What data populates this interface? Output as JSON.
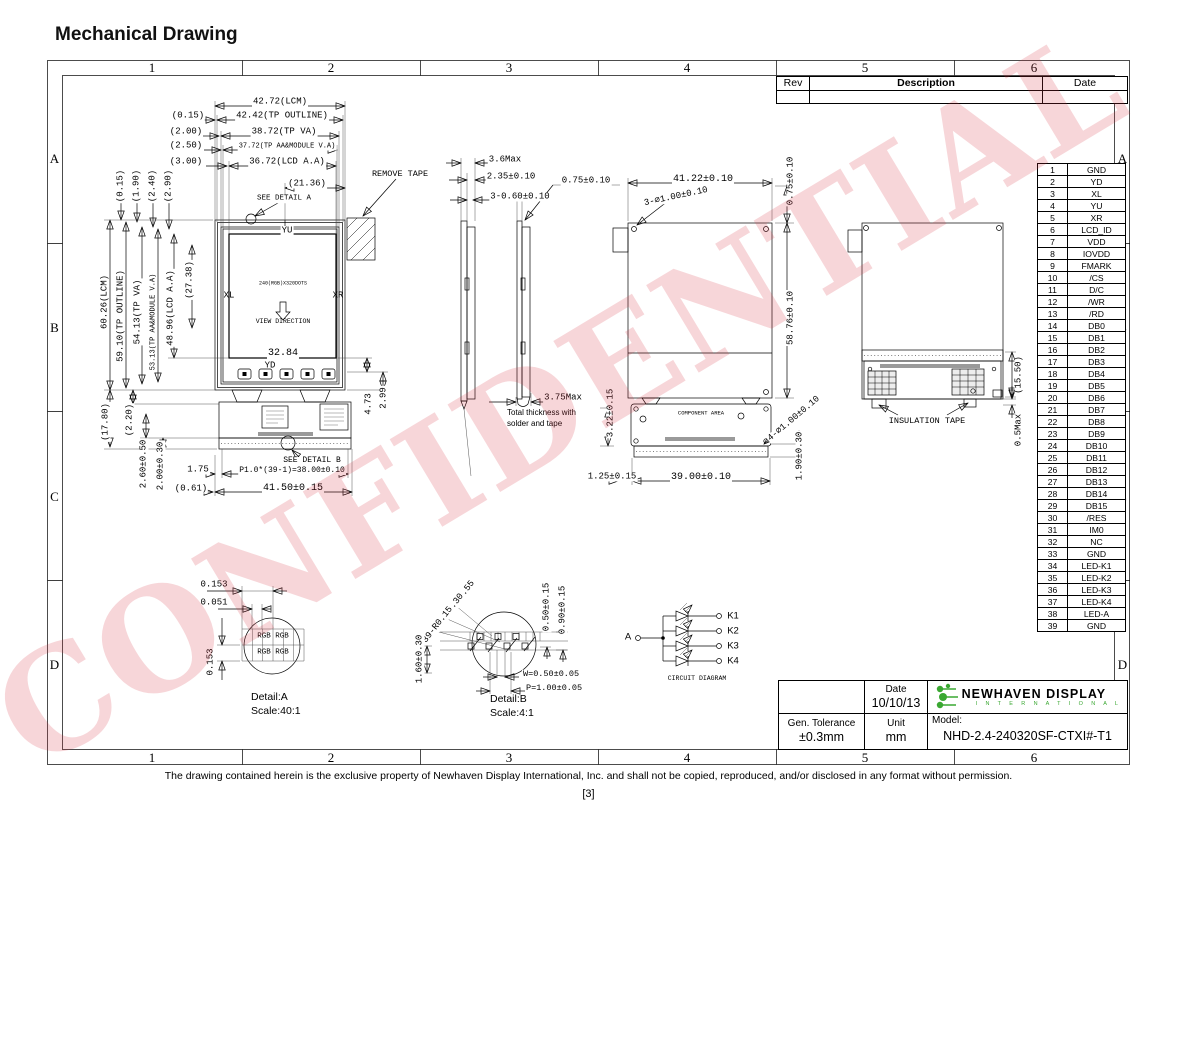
{
  "page": {
    "title": "Mechanical Drawing",
    "watermark": "CONFIDENTIAL",
    "footer": "The drawing contained herein is the exclusive property of Newhaven Display International, Inc. and shall not be copied, reproduced, and/or disclosed in any format without permission.",
    "page_number": "[3]"
  },
  "colors": {
    "watermark": "rgba(213,52,66,0.20)",
    "logo_green": "#3aa832",
    "line": "#000000"
  },
  "grid": {
    "cols": [
      "1",
      "2",
      "3",
      "4",
      "5",
      "6"
    ],
    "rows": [
      "A",
      "B",
      "C",
      "D"
    ]
  },
  "rev_table": {
    "col_rev": "Rev",
    "col_desc": "Description",
    "col_date": "Date",
    "empty_row": [
      "",
      "",
      ""
    ]
  },
  "title_block": {
    "date_label": "Date",
    "date": "10/10/13",
    "tolerance_label": "Gen. Tolerance",
    "tolerance": "±0.3mm",
    "unit_label": "Unit",
    "unit": "mm",
    "model_label": "Model:",
    "model": "NHD-2.4-240320SF-CTXI#-T1"
  },
  "logo": {
    "line1": "NEWHAVEN DISPLAY",
    "line2": "I N T E R N A T I O N A L"
  },
  "pin_table": {
    "pins": [
      {
        "no": "1",
        "name": "GND"
      },
      {
        "no": "2",
        "name": "YD"
      },
      {
        "no": "3",
        "name": "XL"
      },
      {
        "no": "4",
        "name": "YU"
      },
      {
        "no": "5",
        "name": "XR"
      },
      {
        "no": "6",
        "name": "LCD_ID"
      },
      {
        "no": "7",
        "name": "VDD"
      },
      {
        "no": "8",
        "name": "IOVDD"
      },
      {
        "no": "9",
        "name": "FMARK"
      },
      {
        "no": "10",
        "name": "/CS"
      },
      {
        "no": "11",
        "name": "D/C"
      },
      {
        "no": "12",
        "name": "/WR"
      },
      {
        "no": "13",
        "name": "/RD"
      },
      {
        "no": "14",
        "name": "DB0"
      },
      {
        "no": "15",
        "name": "DB1"
      },
      {
        "no": "16",
        "name": "DB2"
      },
      {
        "no": "17",
        "name": "DB3"
      },
      {
        "no": "18",
        "name": "DB4"
      },
      {
        "no": "19",
        "name": "DB5"
      },
      {
        "no": "20",
        "name": "DB6"
      },
      {
        "no": "21",
        "name": "DB7"
      },
      {
        "no": "22",
        "name": "DB8"
      },
      {
        "no": "23",
        "name": "DB9"
      },
      {
        "no": "24",
        "name": "DB10"
      },
      {
        "no": "25",
        "name": "DB11"
      },
      {
        "no": "26",
        "name": "DB12"
      },
      {
        "no": "27",
        "name": "DB13"
      },
      {
        "no": "28",
        "name": "DB14"
      },
      {
        "no": "29",
        "name": "DB15"
      },
      {
        "no": "30",
        "name": "/RES"
      },
      {
        "no": "31",
        "name": "IM0"
      },
      {
        "no": "32",
        "name": "NC"
      },
      {
        "no": "33",
        "name": "GND"
      },
      {
        "no": "34",
        "name": "LED-K1"
      },
      {
        "no": "35",
        "name": "LED-K2"
      },
      {
        "no": "36",
        "name": "LED-K3"
      },
      {
        "no": "37",
        "name": "LED-K4"
      },
      {
        "no": "38",
        "name": "LED-A"
      },
      {
        "no": "39",
        "name": "GND"
      }
    ]
  },
  "dim_labels": [
    {
      "t": "42.72(LCM)",
      "x": 280,
      "y": 102
    },
    {
      "t": "(0.15)",
      "x": 188,
      "y": 116
    },
    {
      "t": "42.42(TP OUTLINE)",
      "x": 282,
      "y": 116
    },
    {
      "t": "(2.00)",
      "x": 186,
      "y": 132
    },
    {
      "t": "38.72(TP VA)",
      "x": 284,
      "y": 132
    },
    {
      "t": "(2.50)",
      "x": 186,
      "y": 146
    },
    {
      "t": "37.72(TP AA&MODULE V.A)",
      "x": 287,
      "y": 147,
      "s": 7
    },
    {
      "t": "(3.00)",
      "x": 186,
      "y": 162
    },
    {
      "t": "36.72(LCD A.A)",
      "x": 287,
      "y": 162
    },
    {
      "t": "(21.36)",
      "x": 307,
      "y": 184
    },
    {
      "t": "SEE DETAIL A",
      "x": 284,
      "y": 199,
      "s": 7.5
    },
    {
      "t": "REMOVE TAPE",
      "x": 400,
      "y": 174,
      "s": 8.5
    },
    {
      "t": "YU",
      "x": 287,
      "y": 231
    },
    {
      "t": "XL",
      "x": 229,
      "y": 296,
      "nb": 1
    },
    {
      "t": "XR",
      "x": 338,
      "y": 296,
      "nb": 1
    },
    {
      "t": "240(RGB)X320DOTS",
      "x": 283,
      "y": 284,
      "s": 5,
      "nb": 1
    },
    {
      "t": "VIEW DIRECTION",
      "x": 283,
      "y": 322,
      "s": 6.5,
      "nb": 1
    },
    {
      "t": "32.84",
      "x": 283,
      "y": 354,
      "s": 10
    },
    {
      "t": "YD",
      "x": 270,
      "y": 366,
      "nb": 1
    },
    {
      "t": "4.73",
      "x": 369,
      "y": 404,
      "r": -90
    },
    {
      "t": "2.99",
      "x": 384,
      "y": 398,
      "r": -90
    },
    {
      "t": "SEE DETAIL B",
      "x": 312,
      "y": 461,
      "s": 8
    },
    {
      "t": "1.75",
      "x": 198,
      "y": 470
    },
    {
      "t": "P1.0*(39-1)=38.00±0.10",
      "x": 292,
      "y": 471,
      "s": 8
    },
    {
      "t": "(0.61)",
      "x": 191,
      "y": 489
    },
    {
      "t": "41.50±0.15",
      "x": 293,
      "y": 489,
      "s": 10
    },
    {
      "t": "(0.15)",
      "x": 121,
      "y": 186,
      "r": -90
    },
    {
      "t": "(1.90)",
      "x": 137,
      "y": 186,
      "r": -90
    },
    {
      "t": "(2.40)",
      "x": 153,
      "y": 186,
      "r": -90
    },
    {
      "t": "(2.90)",
      "x": 169,
      "y": 186,
      "r": -90
    },
    {
      "t": "60.26(LCM)",
      "x": 105,
      "y": 302,
      "r": -90
    },
    {
      "t": "59.10(TP OUTLINE)",
      "x": 121,
      "y": 316,
      "r": -90
    },
    {
      "t": "54.13(TP VA)",
      "x": 138,
      "y": 312,
      "r": -90
    },
    {
      "t": "53.13(TP AA&MODULE V.A)",
      "x": 154,
      "y": 322,
      "r": -90,
      "s": 7
    },
    {
      "t": "48.96(LCD A.A)",
      "x": 171,
      "y": 308,
      "r": -90
    },
    {
      "t": "(27.38)",
      "x": 190,
      "y": 280,
      "r": -90
    },
    {
      "t": "(17.80)",
      "x": 106,
      "y": 422,
      "r": -90
    },
    {
      "t": "(2.20)",
      "x": 130,
      "y": 420,
      "r": -90
    },
    {
      "t": "2.60±0.50",
      "x": 144,
      "y": 464,
      "r": -90
    },
    {
      "t": "2.00±0.30",
      "x": 161,
      "y": 466,
      "r": -90
    },
    {
      "t": "3.6Max",
      "x": 505,
      "y": 160
    },
    {
      "t": "2.35±0.10",
      "x": 511,
      "y": 177
    },
    {
      "t": "3-0.60±0.10",
      "x": 520,
      "y": 197
    },
    {
      "t": "0.75±0.10",
      "x": 586,
      "y": 181
    },
    {
      "t": "3.75Max",
      "x": 563,
      "y": 398
    },
    {
      "t": "Total thickness with",
      "x": 506,
      "y": 413,
      "f": "s",
      "s": 8,
      "a": "l",
      "nb": 1
    },
    {
      "t": "solder and tape",
      "x": 506,
      "y": 424,
      "f": "s",
      "s": 8,
      "a": "l",
      "nb": 1
    },
    {
      "t": "3.22±0.15",
      "x": 611,
      "y": 413,
      "r": -90
    },
    {
      "t": "1.25±0.15",
      "x": 612,
      "y": 477
    },
    {
      "t": "41.22±0.10",
      "x": 703,
      "y": 180,
      "s": 10
    },
    {
      "t": "3-∅1.00±0.10",
      "x": 676,
      "y": 197,
      "r": -12
    },
    {
      "t": "0.75±0.10",
      "x": 791,
      "y": 181,
      "r": -90
    },
    {
      "t": "58.76±0.10",
      "x": 791,
      "y": 318,
      "r": -90
    },
    {
      "t": "COMPONENT AREA",
      "x": 701,
      "y": 413,
      "s": 5.5,
      "nb": 1
    },
    {
      "t": "4-∅1.00±0.10",
      "x": 794,
      "y": 419,
      "r": -40
    },
    {
      "t": "39.00±0.10",
      "x": 701,
      "y": 478,
      "s": 10
    },
    {
      "t": "1.90±0.30",
      "x": 800,
      "y": 456,
      "r": -90
    },
    {
      "t": "INSULATION TAPE",
      "x": 927,
      "y": 421,
      "s": 8.5
    },
    {
      "t": "(15.50)",
      "x": 1019,
      "y": 375,
      "r": -90
    },
    {
      "t": "0.5Max",
      "x": 1019,
      "y": 430,
      "r": -90
    },
    {
      "t": "0.153",
      "x": 214,
      "y": 585
    },
    {
      "t": "0.051",
      "x": 214,
      "y": 603
    },
    {
      "t": "0.153",
      "x": 211,
      "y": 662,
      "r": -90
    },
    {
      "t": "RGB RGB",
      "x": 273,
      "y": 637,
      "s": 7.5,
      "nb": 1
    },
    {
      "t": "RGB RGB",
      "x": 273,
      "y": 653,
      "s": 7.5,
      "nb": 1
    },
    {
      "t": "Detail:A",
      "x": 250,
      "y": 697,
      "f": "s",
      "s": 10.5,
      "a": "l",
      "nb": 1
    },
    {
      "t": "Scale:40:1",
      "x": 250,
      "y": 711,
      "f": "s",
      "s": 10.5,
      "a": "l",
      "nb": 1
    },
    {
      "t": "39-∅0.55",
      "x": 460,
      "y": 599,
      "r": -52
    },
    {
      "t": "39-∅0.30",
      "x": 449,
      "y": 612,
      "r": -52
    },
    {
      "t": "39-R0.15",
      "x": 438,
      "y": 625,
      "r": -52
    },
    {
      "t": "0.50±0.15",
      "x": 547,
      "y": 607,
      "r": -90
    },
    {
      "t": "0.90±0.15",
      "x": 563,
      "y": 610,
      "r": -90
    },
    {
      "t": "1.60±0.30",
      "x": 420,
      "y": 659,
      "r": -90
    },
    {
      "t": "W=0.50±0.05",
      "x": 522,
      "y": 674,
      "a": "l",
      "s": 8.5
    },
    {
      "t": "P=1.00±0.05",
      "x": 525,
      "y": 688,
      "a": "l",
      "s": 8.5
    },
    {
      "t": "Detail:B",
      "x": 489,
      "y": 699,
      "f": "s",
      "s": 10.5,
      "a": "l",
      "nb": 1
    },
    {
      "t": "Scale:4:1",
      "x": 489,
      "y": 713,
      "f": "s",
      "s": 10.5,
      "a": "l",
      "nb": 1
    },
    {
      "t": "K1",
      "x": 733,
      "y": 616,
      "f": "s",
      "s": 9.5,
      "nb": 1
    },
    {
      "t": "K2",
      "x": 733,
      "y": 631,
      "f": "s",
      "s": 9.5,
      "nb": 1
    },
    {
      "t": "K3",
      "x": 733,
      "y": 646,
      "f": "s",
      "s": 9.5,
      "nb": 1
    },
    {
      "t": "K4",
      "x": 733,
      "y": 661,
      "f": "s",
      "s": 9.5,
      "nb": 1
    },
    {
      "t": "A",
      "x": 628,
      "y": 637,
      "f": "s",
      "s": 9.5,
      "nb": 1
    },
    {
      "t": "CIRCUIT DIAGRAM",
      "x": 697,
      "y": 679,
      "s": 6.5,
      "nb": 1
    }
  ]
}
